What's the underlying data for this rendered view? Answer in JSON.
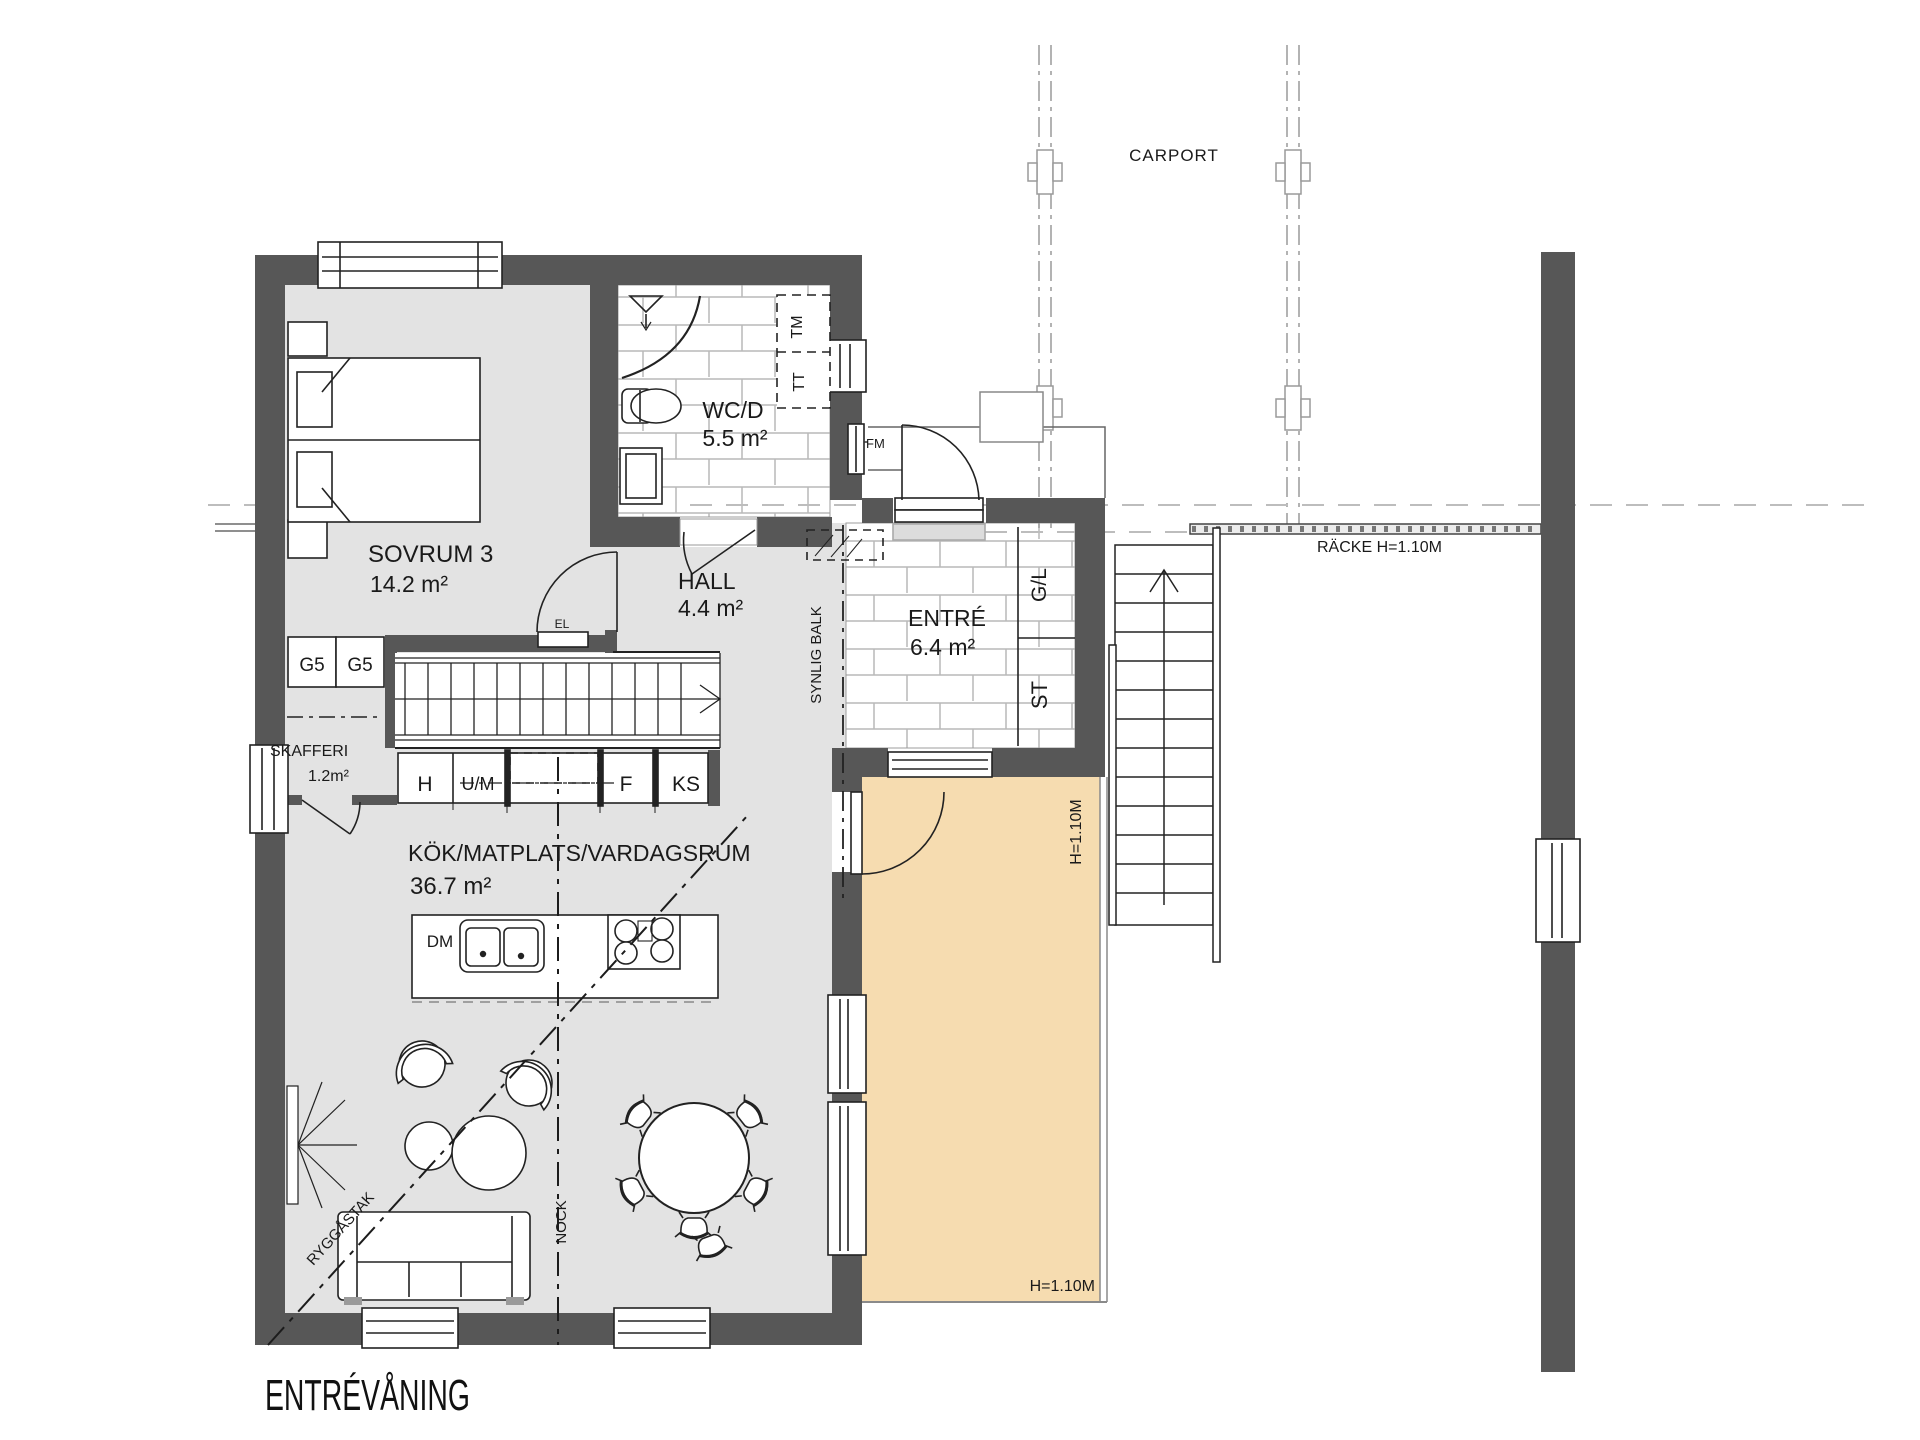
{
  "title": "ENTRÉVÅNING",
  "colors": {
    "wall": "#575757",
    "floor": "#e3e3e3",
    "deck": "#f6dcb0",
    "tile_line": "#b9b9b9",
    "line": "#1c1c1c",
    "dash_gray": "#b5b5b5"
  },
  "carport": {
    "label": "CARPORT"
  },
  "railing": {
    "label": "RÄCKE H=1.10M"
  },
  "deck": {
    "height_side": "H=1.10M",
    "height_bottom": "H=1.10M"
  },
  "rooms": {
    "sovrum3": {
      "name": "SOVRUM 3",
      "area": "14.2 m²"
    },
    "wcd": {
      "name": "WC/D",
      "area": "5.5 m²"
    },
    "hall": {
      "name": "HALL",
      "area": "4.4 m²"
    },
    "entre": {
      "name": "ENTRÉ",
      "area": "6.4 m²"
    },
    "skafferi": {
      "name": "SKAFFERI",
      "area": "1.2m²"
    },
    "kok": {
      "name": "KÖK/MATPLATS/VARDAGSRUM",
      "area": "36.7 m²"
    }
  },
  "annotations": {
    "synlig_balk": "SYNLIG BALK",
    "nock": "NOCK",
    "ryggastak": "RYGGÅSTAK",
    "el": "EL",
    "fm": "FM"
  },
  "fixtures": {
    "tt": "TT",
    "tm": "TM",
    "dm": "DM",
    "g5": "G5",
    "gl": "G/L",
    "st": "ST"
  },
  "kitchen_units": {
    "h": "H",
    "um": "U/M",
    "f": "F",
    "ks": "KS"
  }
}
